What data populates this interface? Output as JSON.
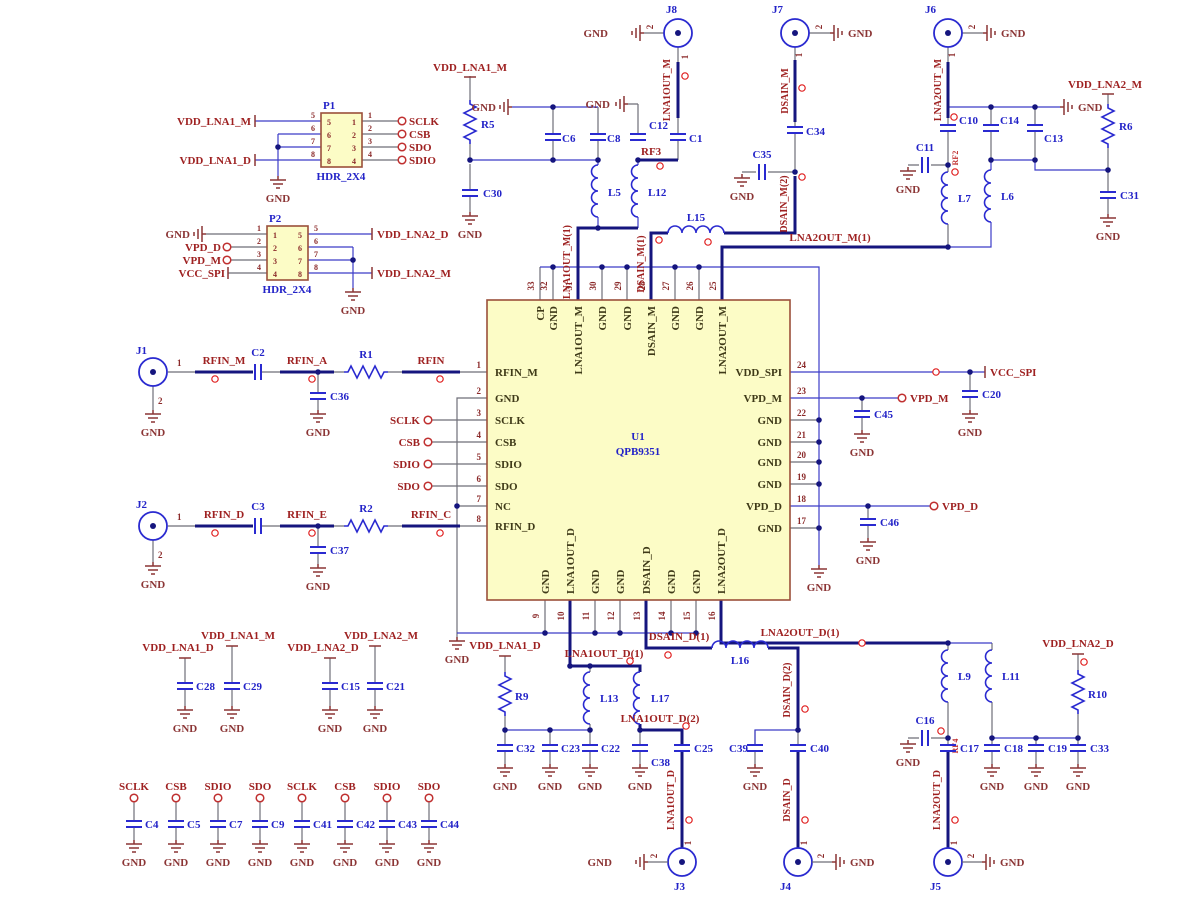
{
  "labels": {
    "gnd": "GND",
    "one": "1",
    "two": "2"
  },
  "ic": {
    "ref": "U1",
    "part": "QPB9351",
    "left": [
      {
        "n": "1",
        "s": "RFIN_M"
      },
      {
        "n": "2",
        "s": "GND"
      },
      {
        "n": "3",
        "s": "SCLK"
      },
      {
        "n": "4",
        "s": "CSB"
      },
      {
        "n": "5",
        "s": "SDIO"
      },
      {
        "n": "6",
        "s": "SDO"
      },
      {
        "n": "7",
        "s": "NC"
      },
      {
        "n": "8",
        "s": "RFIN_D"
      }
    ],
    "right": [
      {
        "n": "24",
        "s": "VDD_SPI"
      },
      {
        "n": "23",
        "s": "VPD_M"
      },
      {
        "n": "22",
        "s": "GND"
      },
      {
        "n": "21",
        "s": "GND"
      },
      {
        "n": "20",
        "s": "GND"
      },
      {
        "n": "19",
        "s": "GND"
      },
      {
        "n": "18",
        "s": "VPD_D"
      },
      {
        "n": "17",
        "s": "GND"
      }
    ],
    "top": [
      {
        "n": "33",
        "s": "CP"
      },
      {
        "n": "32",
        "s": "GND"
      },
      {
        "n": "31",
        "s": "LNA1OUT_M"
      },
      {
        "n": "30",
        "s": "GND"
      },
      {
        "n": "29",
        "s": "GND"
      },
      {
        "n": "28",
        "s": "DSAIN_M"
      },
      {
        "n": "27",
        "s": "GND"
      },
      {
        "n": "26",
        "s": "GND"
      },
      {
        "n": "25",
        "s": "LNA2OUT_M"
      }
    ],
    "bottom": [
      {
        "n": "9",
        "s": "GND"
      },
      {
        "n": "10",
        "s": "LNA1OUT_D"
      },
      {
        "n": "11",
        "s": "GND"
      },
      {
        "n": "12",
        "s": "GND"
      },
      {
        "n": "13",
        "s": "DSAIN_D"
      },
      {
        "n": "14",
        "s": "GND"
      },
      {
        "n": "15",
        "s": "GND"
      },
      {
        "n": "16",
        "s": "LNA2OUT_D"
      }
    ]
  },
  "p1": {
    "ref": "P1",
    "type": "HDR_2X4",
    "pins_left": [
      "5",
      "6",
      "7",
      "8"
    ],
    "pins_right": [
      "1",
      "2",
      "3",
      "4"
    ],
    "net_top": "VDD_LNA1_M",
    "net_bottom": "VDD_LNA1_D",
    "ports": [
      "SCLK",
      "CSB",
      "SDO",
      "SDIO"
    ]
  },
  "p2": {
    "ref": "P2",
    "type": "HDR_2X4",
    "pins_left": [
      "1",
      "2",
      "3",
      "4"
    ],
    "pins_right": [
      "5",
      "6",
      "7",
      "8"
    ],
    "nets_left": [
      "GND",
      "VPD_D",
      "VPD_M",
      "VCC_SPI"
    ],
    "net_r_top": "VDD_LNA2_D",
    "net_r_bottom": "VDD_LNA2_M"
  },
  "connectors": {
    "j1": "J1",
    "j2": "J2",
    "j3": "J3",
    "j4": "J4",
    "j5": "J5",
    "j6": "J6",
    "j7": "J7",
    "j8": "J8"
  },
  "refs": {
    "r1": "R1",
    "r2": "R2",
    "r5": "R5",
    "r6": "R6",
    "r9": "R9",
    "r10": "R10",
    "c1": "C1",
    "c2": "C2",
    "c3": "C3",
    "c4": "C4",
    "c5": "C5",
    "c6": "C6",
    "c7": "C7",
    "c8": "C8",
    "c9": "C9",
    "c10": "C10",
    "c11": "C11",
    "c12": "C12",
    "c13": "C13",
    "c14": "C14",
    "c15": "C15",
    "c16": "C16",
    "c17": "C17",
    "c18": "C18",
    "c19": "C19",
    "c20": "C20",
    "c21": "C21",
    "c22": "C22",
    "c23": "C23",
    "c25": "C25",
    "c28": "C28",
    "c29": "C29",
    "c30": "C30",
    "c31": "C31",
    "c32": "C32",
    "c33": "C33",
    "c34": "C34",
    "c35": "C35",
    "c36": "C36",
    "c37": "C37",
    "c38": "C38",
    "c39": "C39",
    "c40": "C40",
    "c41": "C41",
    "c42": "C42",
    "c43": "C43",
    "c44": "C44",
    "c45": "C45",
    "c46": "C46",
    "l5": "L5",
    "l6": "L6",
    "l7": "L7",
    "l9": "L9",
    "l11": "L11",
    "l12": "L12",
    "l13": "L13",
    "l15": "L15",
    "l16": "L16",
    "l17": "L17"
  },
  "nets": {
    "rfin_m": "RFIN_M",
    "rfin_a": "RFIN_A",
    "rfin": "RFIN",
    "rfin_d": "RFIN_D",
    "rfin_e": "RFIN_E",
    "rfin_c": "RFIN_C",
    "sclk": "SCLK",
    "csb": "CSB",
    "sdio": "SDIO",
    "sdo": "SDO",
    "vdd_lna1_m": "VDD_LNA1_M",
    "vdd_lna1_d": "VDD_LNA1_D",
    "vdd_lna2_m": "VDD_LNA2_M",
    "vdd_lna2_d": "VDD_LNA2_D",
    "vcc_spi": "VCC_SPI",
    "vpd_m": "VPD_M",
    "vpd_d": "VPD_D",
    "lna1out_m": "LNA1OUT_M",
    "lna1out_m1": "LNA1OUT_M(1)",
    "dsain_m": "DSAIN_M",
    "dsain_m1": "DSAIN_M(1)",
    "dsain_m2": "DSAIN_M(2)",
    "lna2out_m": "LNA2OUT_M",
    "lna2out_m1": "LNA2OUT_M(1)",
    "rf2": "RF2",
    "rf3": "RF3",
    "rf4": "RF4",
    "lna1out_d": "LNA1OUT_D",
    "lna1out_d1": "LNA1OUT_D(1)",
    "lna1out_d2": "LNA1OUT_D(2)",
    "dsain_d": "DSAIN_D",
    "dsain_d1": "DSAIN_D(1)",
    "dsain_d2": "DSAIN_D(2)",
    "lna2out_d": "LNA2OUT_D",
    "lna2out_d1": "LNA2OUT_D(1)"
  }
}
